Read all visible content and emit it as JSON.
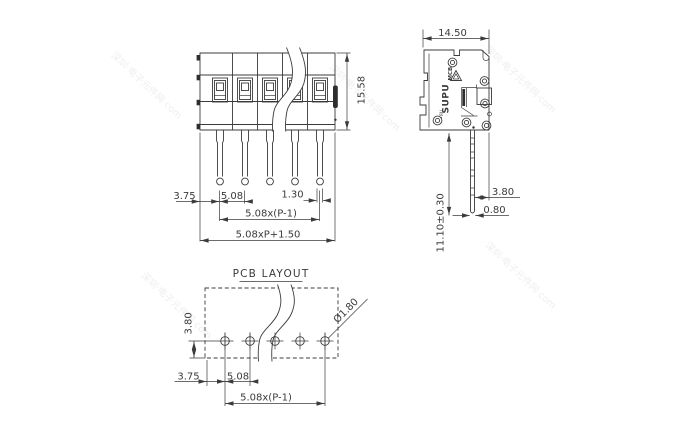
{
  "front_view": {
    "height": "15.58",
    "edge_offset": "3.75",
    "pitch": "5.08",
    "pin_width": "1.30",
    "pitch_span": "5.08x(P-1)",
    "total_width": "5.08xP+1.50"
  },
  "side_view": {
    "width": "14.50",
    "pin_offset": "3.80",
    "pin_thickness": "0.80",
    "pin_length": "11.10±0.30",
    "brand": "SUPU",
    "brand_series": "MCB",
    "ur_mark": "•ЯU"
  },
  "pcb_layout": {
    "title": "PCB LAYOUT",
    "row_offset": "3.80",
    "edge_offset": "3.75",
    "pitch": "5.08",
    "pitch_span": "5.08x(P-1)",
    "hole_diameter": "Ø1.80"
  },
  "watermark": {
    "text": "深圳·电子元件网·com"
  },
  "colors": {
    "line": "#3b3b3b",
    "background": "#ffffff"
  }
}
